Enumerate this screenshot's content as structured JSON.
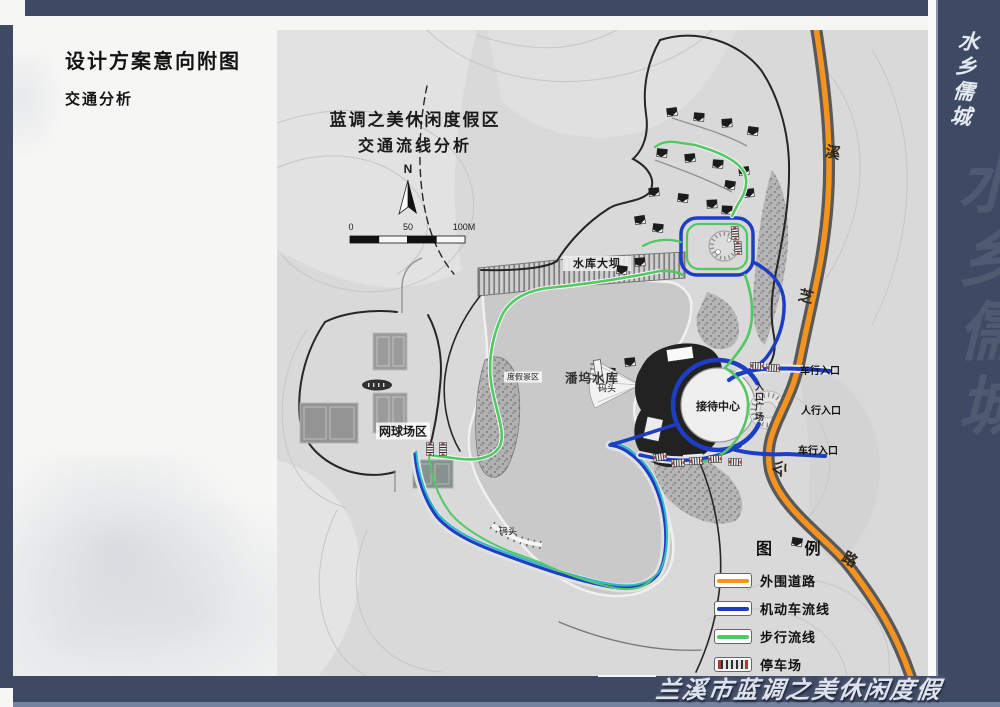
{
  "header": {
    "title": "设计方案意向附图",
    "subtitle": "交通分析"
  },
  "frame": {
    "footer_calligraphy": "兰溪市蓝调之美休闲度假区",
    "side_watermark": "水乡儒城"
  },
  "map": {
    "title_line1": "蓝调之美休闲度假区",
    "title_line2": "交通流线分析",
    "north_label": "N",
    "scale_ticks": {
      "zero": "0",
      "fifty": "50",
      "hundred": "100M"
    },
    "labels": {
      "dam": "水库大坝",
      "reservoir": "潘坞水库",
      "dock_upper": "码头",
      "dock_lower": "码头",
      "tennis_area": "网球场区",
      "scenic_strip": "度假景区",
      "reception_center": "接待中心",
      "entrance_plaza": "入口广场",
      "vehicle_entrance_upper": "车行入口",
      "pedestrian_entrance": "人行入口",
      "vehicle_entrance_lower": "车行入口",
      "road_name": {
        "char1": "溪",
        "char2": "芝",
        "char3": "公",
        "char4": "路"
      }
    },
    "legend": {
      "title": "图 例",
      "items": [
        {
          "label": "外围道路",
          "color": "#f6921e"
        },
        {
          "label": "机动车流线",
          "color": "#1d3ec2"
        },
        {
          "label": "步行流线",
          "color": "#52c763"
        },
        {
          "label": "停车场",
          "color": "striped-parking"
        }
      ]
    }
  },
  "colors": {
    "frame_blue": "#3e4a63",
    "outer_road_orange": "#f6921e",
    "motor_route_blue": "#1d3ec2",
    "walk_route_green": "#52c763",
    "boat_route_teal": "#2fb6c9",
    "water_gray": "#c9c9c9"
  }
}
